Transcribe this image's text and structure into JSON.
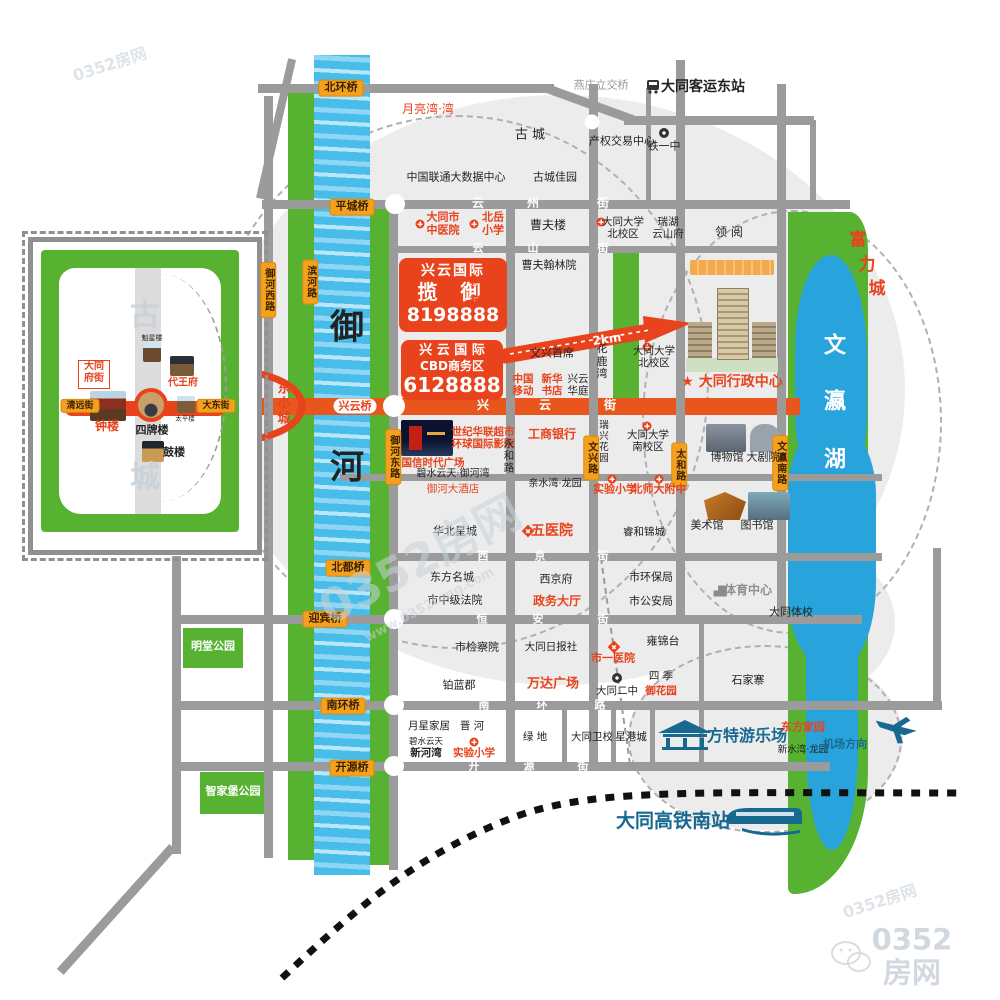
{
  "colors": {
    "accent_red": "#e8431c",
    "road_orange": "#e8561d",
    "badge_orange": "#f5a11d",
    "park_green": "#56b230",
    "river_blue": "#49bdea",
    "lake_blue": "#29a3dc",
    "road_gray": "#9b9b9b",
    "brand_blue": "#17698f"
  },
  "logo": {
    "site": "0352房网",
    "url": "www.0352fang.com"
  },
  "promos": {
    "lanyu": {
      "brand": "兴云国际",
      "name": "揽 御",
      "phone": "8198888",
      "side1": "碧水云天",
      "side2": "御河苑"
    },
    "cbd": {
      "brand": "兴 云 国 际",
      "name": "CBD商务区",
      "phone": "6128888"
    },
    "distance": "2km"
  },
  "labels": [
    {
      "n": "label-yanzhuang-interchange",
      "t": "燕庄立交桥",
      "x": 601,
      "y": 86,
      "fs": 11,
      "cls": "g"
    },
    {
      "n": "label-east-bus-station",
      "t": "大同客运东站",
      "x": 703,
      "y": 87,
      "fs": 14,
      "cls": "b"
    },
    {
      "n": "label-yueliangwan",
      "t": "月亮湾·湾",
      "x": 428,
      "y": 110,
      "fs": 12,
      "cls": "r"
    },
    {
      "n": "label-gucheng",
      "t": "古  城",
      "x": 530,
      "y": 136,
      "fs": 13,
      "cls": "k"
    },
    {
      "n": "label-property-exchange",
      "t": "产权交易中心",
      "x": 622,
      "y": 142,
      "fs": 11,
      "cls": "k"
    },
    {
      "n": "label-tieyizhong",
      "t": "铁一中",
      "x": 664,
      "y": 147,
      "fs": 11,
      "cls": "k"
    },
    {
      "n": "label-unicom-datacenter",
      "t": "中国联通大数据中心",
      "x": 456,
      "y": 178,
      "fs": 11,
      "cls": "k"
    },
    {
      "n": "label-guchengjiayuan",
      "t": "古城佳园",
      "x": 555,
      "y": 178,
      "fs": 11,
      "cls": "k"
    },
    {
      "t": "云",
      "x": 478,
      "y": 204,
      "fs": 12,
      "cls": "w"
    },
    {
      "t": "州",
      "x": 533,
      "y": 204,
      "fs": 12,
      "cls": "w"
    },
    {
      "t": "街",
      "x": 603,
      "y": 204,
      "fs": 12,
      "cls": "w"
    },
    {
      "n": "label-tcm-hospital",
      "t": "大同市\n中医院",
      "x": 443,
      "y": 224,
      "fs": 11,
      "cls": "rb"
    },
    {
      "n": "label-beiyue-primary",
      "t": "北岳\n小学",
      "x": 493,
      "y": 224,
      "fs": 11,
      "cls": "rb"
    },
    {
      "n": "label-caofulou",
      "t": "曹夫楼",
      "x": 548,
      "y": 226,
      "fs": 12,
      "cls": "k"
    },
    {
      "n": "label-datong-univ-north1",
      "t": "大同大学\n北校区",
      "x": 623,
      "y": 228,
      "fs": 10.5,
      "cls": "k"
    },
    {
      "n": "label-ruihu-yunshanfu",
      "t": "瑞湖\n云山府",
      "x": 668,
      "y": 228,
      "fs": 10.5,
      "cls": "k"
    },
    {
      "n": "label-lingyue",
      "t": "领 阅",
      "x": 729,
      "y": 233,
      "fs": 12,
      "cls": "k"
    },
    {
      "t": "云",
      "x": 478,
      "y": 249,
      "fs": 11,
      "cls": "w"
    },
    {
      "t": "山",
      "x": 533,
      "y": 249,
      "fs": 11,
      "cls": "w"
    },
    {
      "t": "街",
      "x": 603,
      "y": 249,
      "fs": 11,
      "cls": "w"
    },
    {
      "n": "label-caofuhanlinyuan",
      "t": "曹夫翰林院",
      "x": 549,
      "y": 266,
      "fs": 11,
      "cls": "k"
    },
    {
      "n": "label-hualuwan",
      "t": "花\n鹿\n湾",
      "x": 602,
      "y": 362,
      "fs": 11,
      "cls": "k"
    },
    {
      "n": "label-wenxingshouxi",
      "t": "文兴首席",
      "x": 552,
      "y": 354,
      "fs": 11,
      "cls": "k"
    },
    {
      "n": "label-datong-univ-north2",
      "t": "大同大学\n北校区",
      "x": 654,
      "y": 357,
      "fs": 10.5,
      "cls": "k"
    },
    {
      "n": "label-china-mobile",
      "t": "中国\n移动",
      "x": 523,
      "y": 385,
      "fs": 10.5,
      "cls": "rb"
    },
    {
      "n": "label-xinhua-bookstore",
      "t": "新华\n书店",
      "x": 552,
      "y": 385,
      "fs": 10.5,
      "cls": "rb"
    },
    {
      "n": "label-xingyunhuating",
      "t": "兴云\n华庭",
      "x": 578,
      "y": 385,
      "fs": 10.5,
      "cls": "k"
    },
    {
      "n": "label-admin-center",
      "t": "★ 大同行政中心",
      "x": 732,
      "y": 382,
      "fs": 14,
      "cls": "rb"
    },
    {
      "t": "兴",
      "x": 483,
      "y": 406,
      "fs": 12,
      "cls": "w"
    },
    {
      "t": "云",
      "x": 545,
      "y": 406,
      "fs": 12,
      "cls": "w"
    },
    {
      "t": "街",
      "x": 610,
      "y": 406,
      "fs": 12,
      "cls": "w"
    },
    {
      "n": "label-xingyun-bridge",
      "t": "兴云桥",
      "x": 355,
      "y": 406,
      "fs": 11,
      "cls": "rb pill"
    },
    {
      "n": "label-dongxiaocheng",
      "t": "东\n小\n城",
      "x": 284,
      "y": 405,
      "fs": 13,
      "cls": "rb"
    },
    {
      "n": "label-yuhe-up",
      "t": "御",
      "x": 347,
      "y": 328,
      "fs": 34,
      "cls": "b"
    },
    {
      "n": "label-yuhe-down",
      "t": "河",
      "x": 347,
      "y": 468,
      "fs": 34,
      "cls": "b"
    },
    {
      "n": "label-guoxin-plaza",
      "t": "国信时代广场",
      "x": 433,
      "y": 463,
      "fs": 10.5,
      "cls": "rb"
    },
    {
      "n": "label-century-mart",
      "t": "世纪华联超市\n环球国际影院",
      "x": 483,
      "y": 438,
      "fs": 10.5,
      "cls": "rb"
    },
    {
      "n": "label-icbc",
      "t": "工商银行",
      "x": 552,
      "y": 435,
      "fs": 12,
      "cls": "rb"
    },
    {
      "n": "label-yonghe-road",
      "t": "永\n和\n路",
      "x": 509,
      "y": 456,
      "fs": 10.5,
      "cls": "k"
    },
    {
      "n": "label-ruixing-garden",
      "t": "瑞\n兴\n花\n园",
      "x": 604,
      "y": 443,
      "fs": 9.5,
      "cls": "k"
    },
    {
      "n": "label-datong-univ-south",
      "t": "大同大学\n南校区",
      "x": 648,
      "y": 441,
      "fs": 10.5,
      "cls": "k"
    },
    {
      "n": "label-museum",
      "t": "博物馆",
      "x": 727,
      "y": 458,
      "fs": 11,
      "cls": "k"
    },
    {
      "n": "label-theatre",
      "t": "大剧院",
      "x": 763,
      "y": 458,
      "fs": 11,
      "cls": "k"
    },
    {
      "n": "label-bishuiyuntian-yuhewan",
      "t": "碧水云天·御河湾",
      "x": 453,
      "y": 474,
      "fs": 10,
      "cls": "k"
    },
    {
      "n": "label-yuhe-hotel",
      "t": "御河大酒店",
      "x": 453,
      "y": 489,
      "fs": 10.5,
      "cls": "r"
    },
    {
      "n": "label-qinshuiwan",
      "t": "亲水湾·龙园",
      "x": 555,
      "y": 484,
      "fs": 10,
      "cls": "k"
    },
    {
      "n": "label-experimental-primary1",
      "t": "实验小学",
      "x": 615,
      "y": 490,
      "fs": 11,
      "cls": "rb"
    },
    {
      "n": "label-beishida",
      "t": "北师大附中",
      "x": 659,
      "y": 490,
      "fs": 11,
      "cls": "rb"
    },
    {
      "n": "label-art-gallery",
      "t": "美术馆",
      "x": 707,
      "y": 526,
      "fs": 11,
      "cls": "k"
    },
    {
      "n": "label-library",
      "t": "图书馆",
      "x": 757,
      "y": 526,
      "fs": 11,
      "cls": "k"
    },
    {
      "n": "label-huabeixingcheng",
      "t": "华北星城",
      "x": 455,
      "y": 532,
      "fs": 11,
      "cls": "k"
    },
    {
      "n": "label-fifth-hospital",
      "t": "五医院",
      "x": 552,
      "y": 531,
      "fs": 14,
      "cls": "rb"
    },
    {
      "n": "label-ruihejincheng",
      "t": "睿和锦城",
      "x": 644,
      "y": 532,
      "fs": 10.5,
      "cls": "k"
    },
    {
      "t": "西",
      "x": 483,
      "y": 557,
      "fs": 11,
      "cls": "w"
    },
    {
      "t": "京",
      "x": 540,
      "y": 557,
      "fs": 11,
      "cls": "w"
    },
    {
      "t": "街",
      "x": 603,
      "y": 557,
      "fs": 11,
      "cls": "w"
    },
    {
      "n": "label-dongfangmingcheng",
      "t": "东方名城",
      "x": 452,
      "y": 578,
      "fs": 11,
      "cls": "k"
    },
    {
      "n": "label-xijingfu",
      "t": "西京府",
      "x": 556,
      "y": 580,
      "fs": 11,
      "cls": "k"
    },
    {
      "n": "label-epa",
      "t": "市环保局",
      "x": 651,
      "y": 578,
      "fs": 11,
      "cls": "k"
    },
    {
      "n": "label-sports-center",
      "t": "体育中心",
      "x": 748,
      "y": 591,
      "fs": 12,
      "cls": "g2"
    },
    {
      "n": "label-intermediate-court",
      "t": "市中级法院",
      "x": 455,
      "y": 601,
      "fs": 11,
      "cls": "k"
    },
    {
      "n": "label-government-hall",
      "t": "政务大厅",
      "x": 557,
      "y": 602,
      "fs": 12,
      "cls": "rb"
    },
    {
      "n": "label-public-security",
      "t": "市公安局",
      "x": 651,
      "y": 602,
      "fs": 11,
      "cls": "k"
    },
    {
      "n": "label-sports-school",
      "t": "大同体校",
      "x": 791,
      "y": 613,
      "fs": 11,
      "cls": "k"
    },
    {
      "t": "恒",
      "x": 482,
      "y": 620,
      "fs": 11,
      "cls": "w"
    },
    {
      "t": "安",
      "x": 538,
      "y": 620,
      "fs": 11,
      "cls": "w"
    },
    {
      "t": "街",
      "x": 603,
      "y": 620,
      "fs": 11,
      "cls": "w"
    },
    {
      "n": "label-procuratorate",
      "t": "市检察院",
      "x": 477,
      "y": 648,
      "fs": 11,
      "cls": "k"
    },
    {
      "n": "label-daily-press",
      "t": "大同日报社",
      "x": 551,
      "y": 647,
      "fs": 10.5,
      "cls": "k"
    },
    {
      "n": "label-first-hospital",
      "t": "市一医院",
      "x": 613,
      "y": 659,
      "fs": 11,
      "cls": "rb"
    },
    {
      "n": "label-yongjintai",
      "t": "雍锦台",
      "x": 663,
      "y": 642,
      "fs": 11,
      "cls": "k"
    },
    {
      "n": "label-bolanjun",
      "t": "铂蓝郡",
      "x": 459,
      "y": 686,
      "fs": 11,
      "cls": "k"
    },
    {
      "n": "label-wanda-plaza",
      "t": "万达广场",
      "x": 553,
      "y": 685,
      "fs": 13,
      "cls": "rb"
    },
    {
      "n": "label-no2-middle",
      "t": "大同二中",
      "x": 617,
      "y": 691,
      "fs": 10.5,
      "cls": "k"
    },
    {
      "n": "label-siji",
      "t": "四 季",
      "x": 661,
      "y": 676,
      "fs": 10.5,
      "cls": "k"
    },
    {
      "n": "label-yuhuayuan",
      "t": "御花园",
      "x": 661,
      "y": 691,
      "fs": 10.5,
      "cls": "rb"
    },
    {
      "n": "label-shijiazhai",
      "t": "石家寨",
      "x": 748,
      "y": 681,
      "fs": 11,
      "cls": "k"
    },
    {
      "t": "南",
      "x": 484,
      "y": 706,
      "fs": 11,
      "cls": "w"
    },
    {
      "t": "环",
      "x": 542,
      "y": 706,
      "fs": 11,
      "cls": "w"
    },
    {
      "t": "路",
      "x": 600,
      "y": 706,
      "fs": 11,
      "cls": "w"
    },
    {
      "n": "label-yuexing-furniture",
      "t": "月星家居",
      "x": 429,
      "y": 726,
      "fs": 10.5,
      "cls": "k"
    },
    {
      "n": "label-jinhe",
      "t": "晋 河",
      "x": 472,
      "y": 726,
      "fs": 10.5,
      "cls": "k"
    },
    {
      "t": "碧水云天",
      "x": 426,
      "y": 743,
      "fs": 8.5,
      "cls": "k"
    },
    {
      "n": "label-xinhewan",
      "t": "新河湾",
      "x": 426,
      "y": 753,
      "fs": 10.5,
      "cls": "b"
    },
    {
      "n": "label-experimental-primary2",
      "t": "实验小学",
      "x": 474,
      "y": 753,
      "fs": 10.5,
      "cls": "rb"
    },
    {
      "n": "label-lvdi",
      "t": "绿 地",
      "x": 535,
      "y": 737,
      "fs": 10.5,
      "cls": "k"
    },
    {
      "n": "label-health-school",
      "t": "大同卫校",
      "x": 592,
      "y": 737,
      "fs": 10.5,
      "cls": "k"
    },
    {
      "n": "label-xinggangcheng",
      "t": "星港城",
      "x": 631,
      "y": 737,
      "fs": 10.5,
      "cls": "k"
    },
    {
      "n": "label-fangte-park",
      "t": "方特游乐场",
      "x": 747,
      "y": 736,
      "fs": 16,
      "cls": "bl"
    },
    {
      "n": "label-dongfangjiayuan",
      "t": "东方家园",
      "x": 803,
      "y": 728,
      "fs": 11,
      "cls": "rb"
    },
    {
      "n": "label-xinshuiwan",
      "t": "新水湾·龙园",
      "x": 803,
      "y": 751,
      "fs": 9.5,
      "cls": "k"
    },
    {
      "n": "label-airport-direction",
      "t": "机场方向",
      "x": 845,
      "y": 745,
      "fs": 11,
      "cls": "bl"
    },
    {
      "t": "开",
      "x": 474,
      "y": 767,
      "fs": 11,
      "cls": "w"
    },
    {
      "t": "源",
      "x": 529,
      "y": 767,
      "fs": 11,
      "cls": "w"
    },
    {
      "t": "街",
      "x": 583,
      "y": 767,
      "fs": 11,
      "cls": "w"
    },
    {
      "n": "label-mingtang-park",
      "t": "明堂公园",
      "x": 213,
      "y": 647,
      "fs": 11,
      "cls": "wb"
    },
    {
      "n": "label-zhijiabu-park",
      "t": "智家堡公园",
      "x": 233,
      "y": 792,
      "fs": 11,
      "cls": "wb"
    },
    {
      "n": "label-hsr-south-station",
      "t": "大同高铁南站",
      "x": 673,
      "y": 822,
      "fs": 19,
      "cls": "bl"
    },
    {
      "t": "富",
      "x": 858,
      "y": 241,
      "fs": 17,
      "cls": "rb"
    },
    {
      "t": "力",
      "x": 867,
      "y": 266,
      "fs": 17,
      "cls": "rb"
    },
    {
      "t": "城",
      "x": 877,
      "y": 290,
      "fs": 17,
      "cls": "rb"
    },
    {
      "n": "label-wenying-lake",
      "t": "文",
      "x": 835,
      "y": 346,
      "fs": 22,
      "cls": "wb"
    },
    {
      "t": "瀛",
      "x": 835,
      "y": 402,
      "fs": 22,
      "cls": "wb"
    },
    {
      "t": "湖",
      "x": 835,
      "y": 460,
      "fs": 22,
      "cls": "wb"
    },
    {
      "n": "inset-kuixinglou",
      "t": "魁星楼",
      "x": 152,
      "y": 338,
      "fs": 7,
      "cls": "k"
    },
    {
      "n": "inset-daiwangfu",
      "t": "代王府",
      "x": 183,
      "y": 383,
      "fs": 10,
      "cls": "rb"
    },
    {
      "n": "inset-zhonglou",
      "t": "钟楼",
      "x": 107,
      "y": 427,
      "fs": 12,
      "cls": "rb"
    },
    {
      "n": "inset-sipailou",
      "t": "四牌楼",
      "x": 152,
      "y": 431,
      "fs": 11,
      "cls": "b"
    },
    {
      "n": "inset-taipinglou",
      "t": "太平楼",
      "x": 185,
      "y": 419,
      "fs": 6.5,
      "cls": "k"
    },
    {
      "n": "inset-gulou",
      "t": "鼓楼",
      "x": 174,
      "y": 453,
      "fs": 11,
      "cls": "b"
    },
    {
      "t": "古",
      "x": 145,
      "y": 316,
      "fs": 30,
      "cls": "wm",
      "o": 0.9
    },
    {
      "t": "城",
      "x": 145,
      "y": 478,
      "fs": 30,
      "cls": "wm",
      "o": 0.9
    },
    {
      "n": "watermark-center",
      "t": "0352房网",
      "x": 420,
      "y": 560,
      "fs": 46,
      "cls": "wm",
      "rot": -28
    },
    {
      "n": "watermark-url",
      "t": "www.0352fang.com",
      "x": 430,
      "y": 606,
      "fs": 13,
      "cls": "wm",
      "rot": -28
    },
    {
      "n": "watermark-topleft",
      "t": "0352房网",
      "x": 110,
      "y": 65,
      "fs": 16,
      "cls": "wm",
      "rot": -18,
      "o": 0.6
    },
    {
      "n": "watermark-bottomright",
      "t": "0352房网",
      "x": 880,
      "y": 902,
      "fs": 16,
      "cls": "wm",
      "rot": -18,
      "o": 0.6
    },
    {
      "n": "footer-logo-text",
      "t": "0352房网",
      "x": 912,
      "y": 957,
      "fs": 29,
      "cls": "wm",
      "o": 0.85
    },
    {
      "n": "label-2km",
      "t": "2km",
      "x": 607,
      "y": 340,
      "fs": 12,
      "cls": "wb",
      "rot": -8
    }
  ],
  "badges": [
    {
      "n": "bridge-beihuanqiao",
      "t": "北环桥",
      "x": 341,
      "y": 88
    },
    {
      "n": "bridge-pingchengqiao",
      "t": "平城桥",
      "x": 352,
      "y": 207
    },
    {
      "n": "bridge-beiduqiao",
      "t": "北都桥",
      "x": 348,
      "y": 568
    },
    {
      "n": "bridge-yingbinqiao",
      "t": "迎宾桥",
      "x": 325,
      "y": 619
    },
    {
      "n": "bridge-nanhuanqiao",
      "t": "南环桥",
      "x": 343,
      "y": 706
    },
    {
      "n": "bridge-kaiyuanqiao",
      "t": "开源桥",
      "x": 352,
      "y": 768
    },
    {
      "n": "road-yuhe-west",
      "t": "御河西路",
      "x": 268,
      "y": 290,
      "v": true,
      "fs": 10
    },
    {
      "n": "road-binhe",
      "t": "滨河路",
      "x": 310,
      "y": 282,
      "v": true,
      "fs": 10
    },
    {
      "n": "road-yuhe-east",
      "t": "御河东路",
      "x": 393,
      "y": 457,
      "v": true,
      "fs": 10
    },
    {
      "n": "road-wenxing",
      "t": "文兴路",
      "x": 591,
      "y": 458,
      "v": true,
      "fs": 10
    },
    {
      "n": "road-taihe",
      "t": "太和路",
      "x": 679,
      "y": 465,
      "v": true,
      "fs": 10
    },
    {
      "n": "road-wenying-south",
      "t": "文瀛南路",
      "x": 780,
      "y": 463,
      "v": true,
      "fs": 10
    },
    {
      "n": "inset-qingyuan-street",
      "t": "清远街",
      "x": 80,
      "y": 406,
      "fs": 9
    },
    {
      "n": "inset-dadong-street",
      "t": "大东街",
      "x": 216,
      "y": 406,
      "fs": 9
    }
  ],
  "inset": {
    "fustreet": "大同\n府街"
  },
  "icons": [
    {
      "type": "hospital",
      "x": 420,
      "y": 224
    },
    {
      "type": "school",
      "x": 474,
      "y": 224
    },
    {
      "type": "school",
      "x": 601,
      "y": 222
    },
    {
      "type": "school",
      "x": 647,
      "y": 347
    },
    {
      "type": "school",
      "x": 647,
      "y": 426
    },
    {
      "type": "school",
      "x": 612,
      "y": 479
    },
    {
      "type": "school",
      "x": 659,
      "y": 479
    },
    {
      "type": "school",
      "x": 474,
      "y": 742
    },
    {
      "type": "diamond",
      "x": 528,
      "y": 531
    },
    {
      "type": "diamond",
      "x": 614,
      "y": 647
    },
    {
      "type": "dark",
      "x": 664,
      "y": 133
    },
    {
      "type": "dark",
      "x": 617,
      "y": 678
    },
    {
      "type": "building",
      "x": 720,
      "y": 591
    }
  ],
  "junctions": [
    {
      "x": 395,
      "y": 204,
      "d": 20
    },
    {
      "x": 394,
      "y": 406,
      "d": 22
    },
    {
      "x": 394,
      "y": 619,
      "d": 20
    },
    {
      "x": 394,
      "y": 705,
      "d": 20
    },
    {
      "x": 394,
      "y": 766,
      "d": 20
    },
    {
      "x": 592,
      "y": 122,
      "d": 15
    }
  ]
}
